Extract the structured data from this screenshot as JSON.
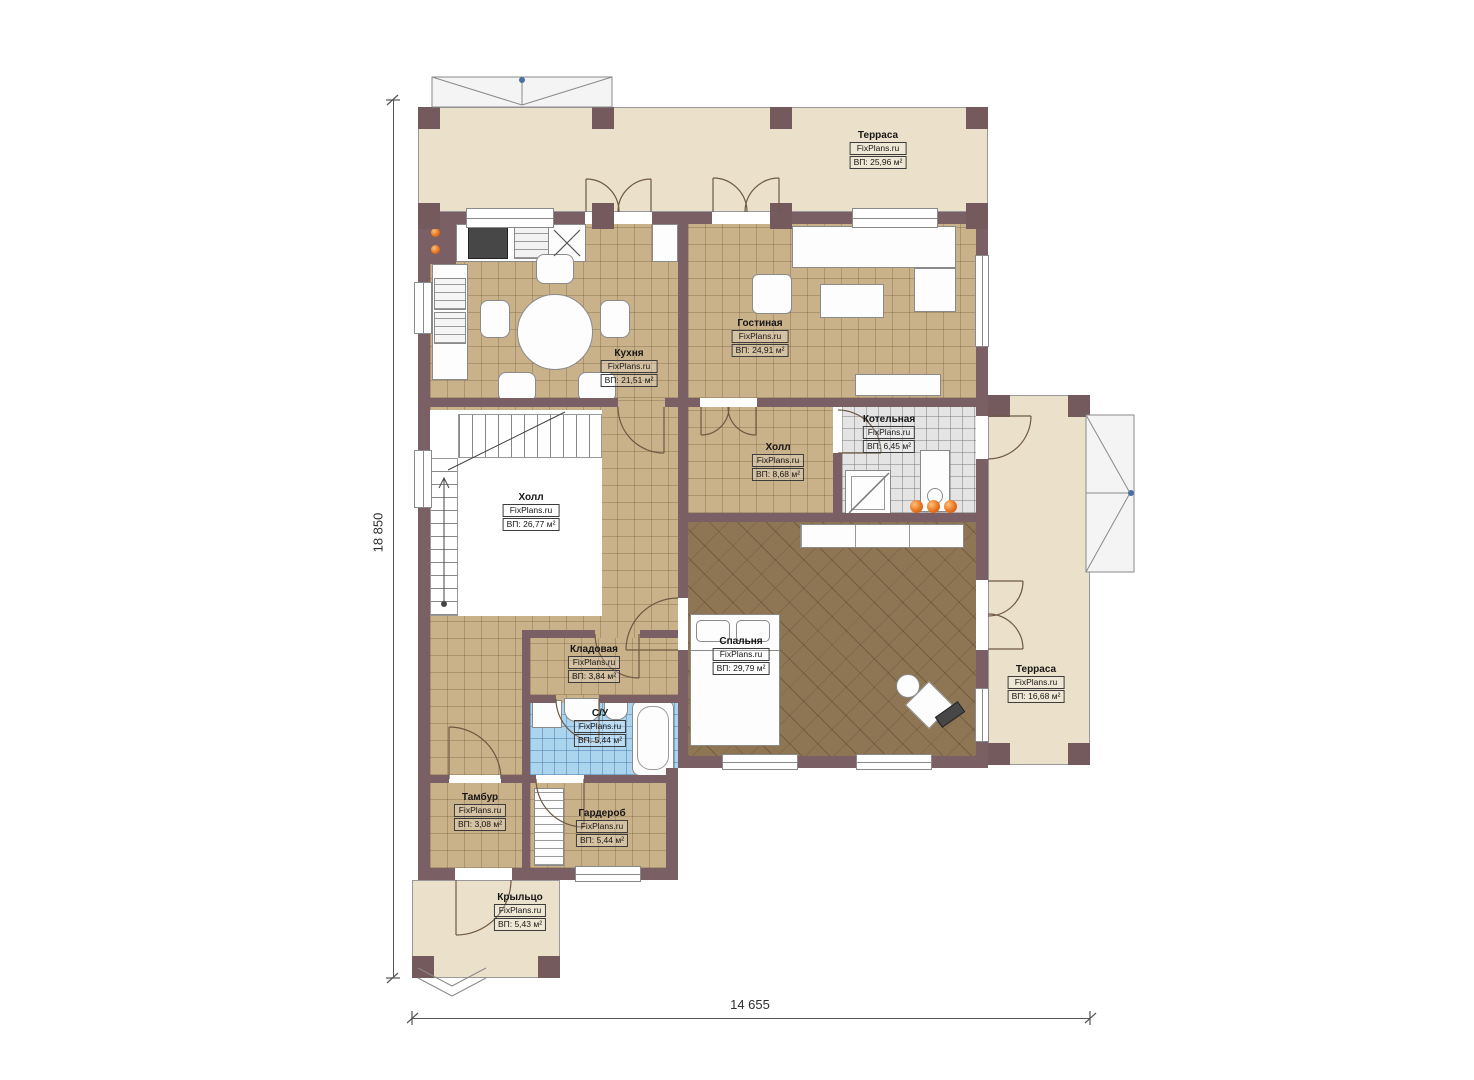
{
  "watermark": "FixPlans.ru",
  "dims": {
    "left": "18 850",
    "bottom": "14 655"
  },
  "rooms": [
    {
      "name": "Терраса",
      "area": "ВП: 25,96 м²"
    },
    {
      "name": "Кухня",
      "area": "ВП: 21,51 м²"
    },
    {
      "name": "Гостиная",
      "area": "ВП: 24,91 м²"
    },
    {
      "name": "Котельная",
      "area": "ВП: 6,45 м²"
    },
    {
      "name": "Холл",
      "area": "ВП: 8,68 м²"
    },
    {
      "name": "Холл",
      "area": "ВП: 26,77 м²"
    },
    {
      "name": "Спальня",
      "area": "ВП: 29,79 м²"
    },
    {
      "name": "Кладовая",
      "area": "ВП: 3,84 м²"
    },
    {
      "name": "С/У",
      "area": "ВП: 5,44 м²"
    },
    {
      "name": "Тамбур",
      "area": "ВП: 3,08 м²"
    },
    {
      "name": "Гардероб",
      "area": "ВП: 5,44 м²"
    },
    {
      "name": "Крыльцо",
      "area": "ВП: 5,43 м²"
    },
    {
      "name": "Терраса",
      "area": "ВП: 16,68 м²"
    }
  ],
  "colors": {
    "wall": "#7a6064",
    "floor_tan": "#c9b18a",
    "terrace": "#ebe0c9",
    "bedroom_floor": "#8e7554",
    "tile_gray": "#e4e4e4",
    "tile_blue": "#abd4ef",
    "accent_orange": "#e8731e"
  }
}
